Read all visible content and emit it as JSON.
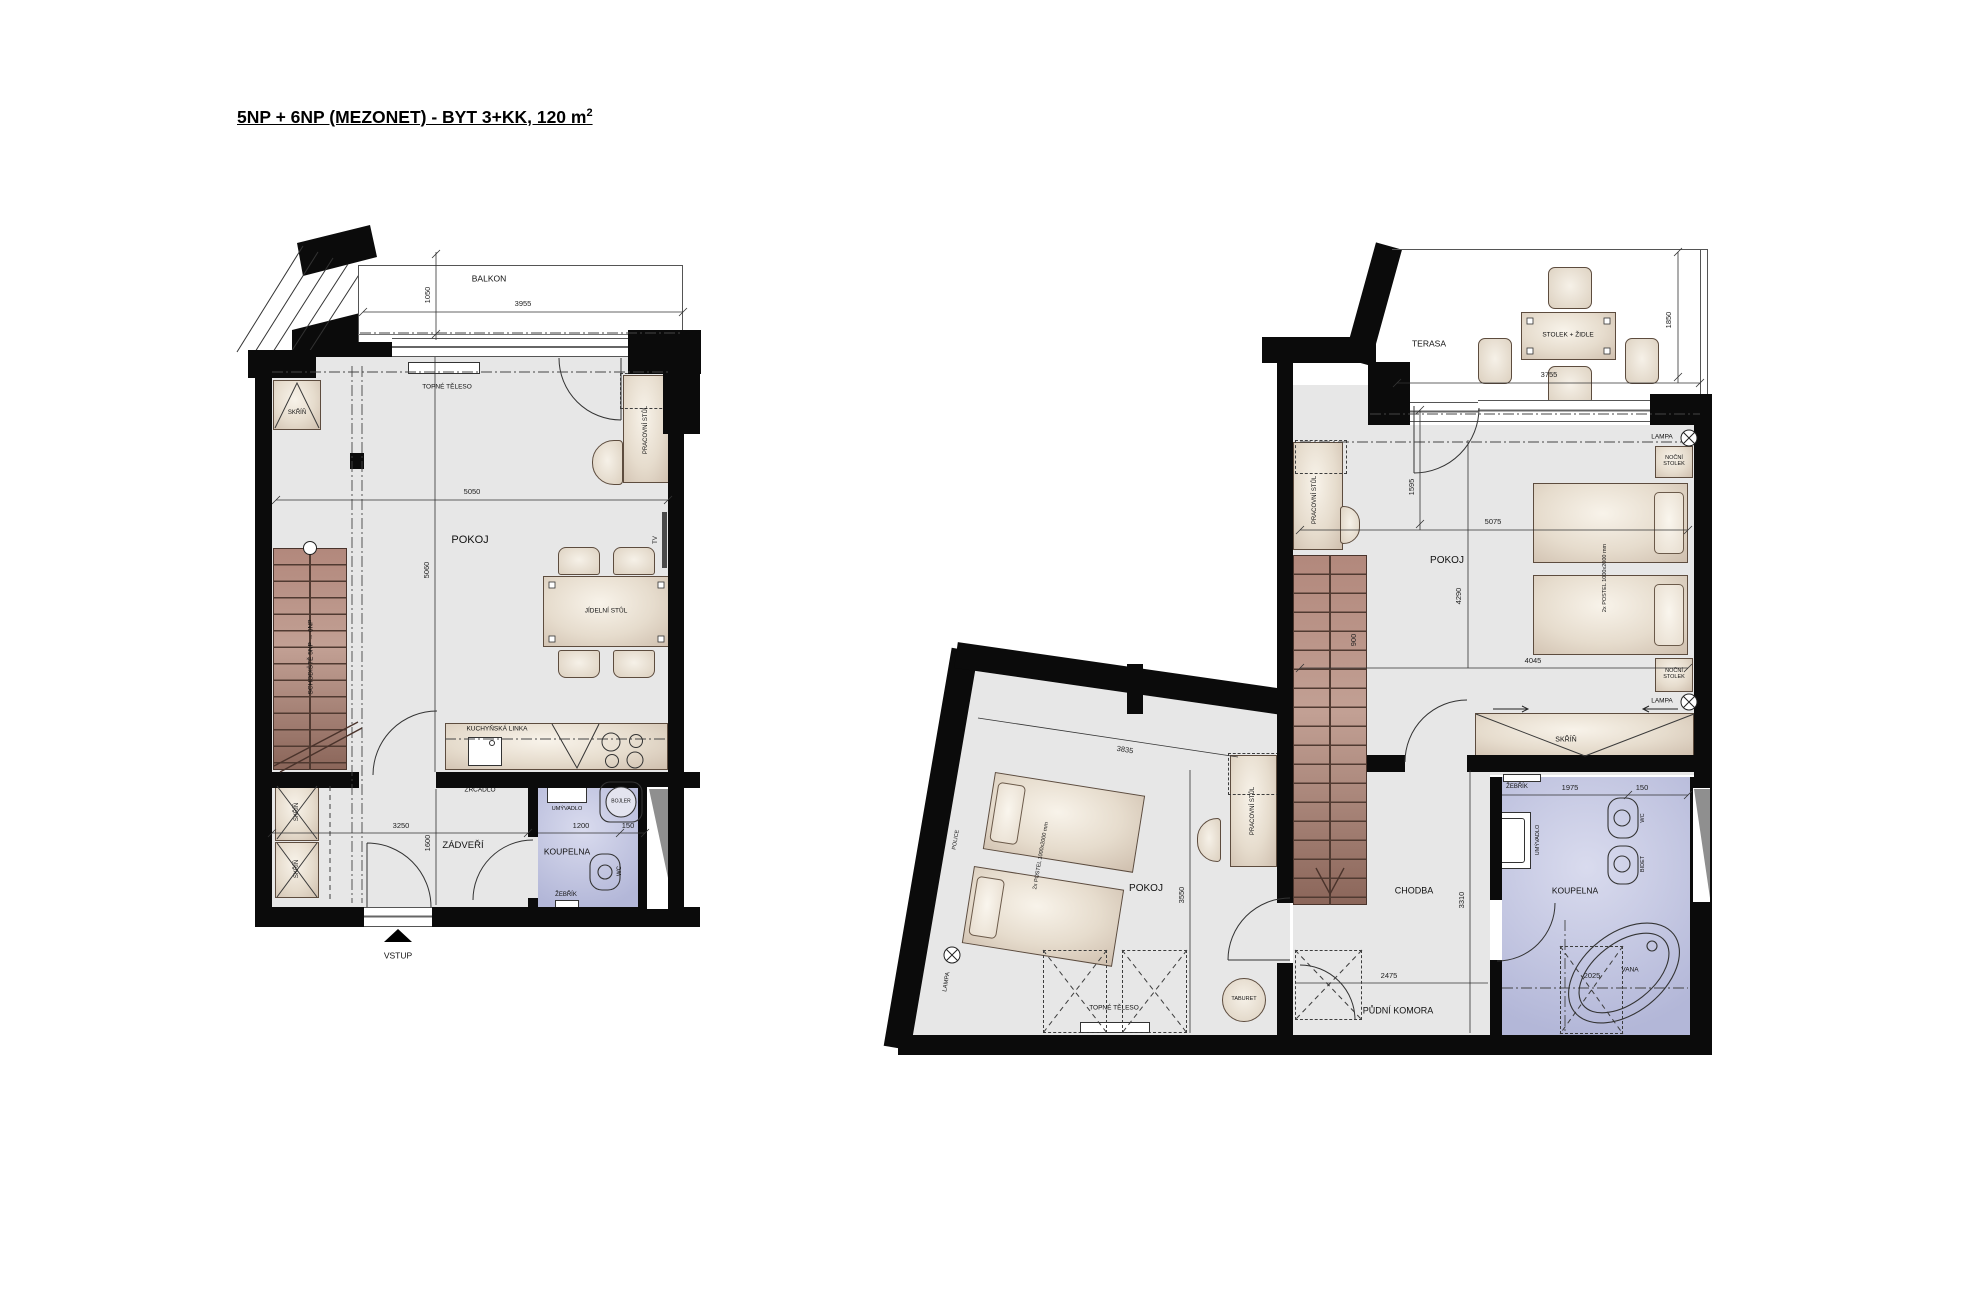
{
  "title": {
    "main": "5NP + 6NP (MEZONET) - BYT 3+KK, 120 m",
    "sup": "2"
  },
  "left": {
    "floor": "5NP",
    "labels": {
      "balkon": "BALKON",
      "skrin": "SKŘÍŇ",
      "topne_teleso": "TOPNÉ TĚLESO",
      "pracovni_stul": "PRACOVNÍ STŮL",
      "pokoj": "POKOJ",
      "jidelni_stul": "JÍDELNÍ STŮL",
      "tv": "TV",
      "schodiste": "SCHODIŠTĚ 5NP → 6NP",
      "kuchynska_linka": "KUCHYŇSKÁ LINKA",
      "zrcadlo": "ZRCADLO",
      "zadveri": "ZÁDVEŘÍ",
      "umyvadlo": "UMÝVADLO",
      "bojler": "BOJLER",
      "koupelna": "KOUPELNA",
      "wc": "WC",
      "zebrik": "ŽEBŘÍK",
      "vstup": "VSTUP"
    },
    "dims": {
      "balkon_h": "1050",
      "balkon_w": "3955",
      "pokoj_w": "5050",
      "pokoj_h": "5060",
      "zadveri_w": "3250",
      "zadveri_h": "1600",
      "koupelna_w": "1200",
      "koupelna_niche": "150"
    }
  },
  "right": {
    "floor": "6NP",
    "labels": {
      "terasa": "TERASA",
      "stolek_zidle": "STOLEK + ŽIDLE",
      "lampa": "LAMPA",
      "nocni_stolek": "NOČNÍ STOLEK",
      "pokoj": "POKOJ",
      "postel": "2x POSTEL 1000x2000 mm",
      "skrin": "SKŘÍŇ",
      "pracovni_stul": "PRACOVNÍ STŮL",
      "chodba": "CHODBA",
      "pudni_komora": "PŮDNÍ KOMORA",
      "police": "POLICE",
      "taburet": "TABURET",
      "topne_teleso": "TOPNÉ TĚLESO",
      "zebrik": "ŽEBŘÍK",
      "umyvadlo": "UMÝVADLO",
      "wc": "WC",
      "bidet": "BIDET",
      "koupelna": "KOUPELNA",
      "vana": "VANA"
    },
    "dims": {
      "terasa_w": "3755",
      "terasa_h": "1850",
      "door": "1595",
      "pokoj_w": "5075",
      "pokoj_h": "4290",
      "pokoj_w2": "4045",
      "schodiste": "900",
      "pokoj2_w": "3835",
      "pokoj2_h": "3550",
      "chodba_h": "3310",
      "chodba_w": "2475",
      "koupelna_w": "1975",
      "koupelna_niche": "150",
      "vana_w": "2025"
    }
  },
  "colors": {
    "wall": "#0b0b0b",
    "floor": "#e7e7e7",
    "bathroom": "#b9bdd9",
    "wood": "#a28378",
    "furniture": "#e8ddcd"
  }
}
